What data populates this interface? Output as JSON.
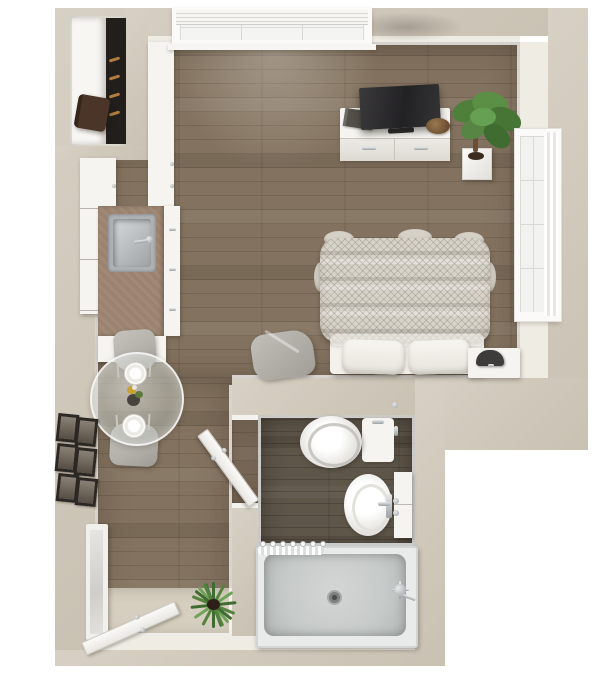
{
  "scene": {
    "title": "Studio apartment 3D top-down floor plan render",
    "view": "top-down 3D render",
    "rooms": [
      {
        "name": "living-sleeping-area"
      },
      {
        "name": "kitchenette"
      },
      {
        "name": "dining-nook"
      },
      {
        "name": "bathroom"
      },
      {
        "name": "entry"
      },
      {
        "name": "closet"
      }
    ],
    "objects": [
      "top-window-with-blinds",
      "side-window-with-curtain",
      "tv-console",
      "flat-screen-tv",
      "book",
      "decor-bowl",
      "potted-corner-plant",
      "bed-with-knit-blanket",
      "two-pillows",
      "nightstand",
      "lamp",
      "gray-lounge-pouf",
      "round-glass-dining-table",
      "two-dining-chairs",
      "two-place-settings",
      "flower-centerpiece",
      "kitchen-counter-with-sink",
      "upper-cabinets",
      "pantry-cabinet",
      "closet-shelf",
      "hanging-clothes",
      "duffel-bag",
      "gallery-wall-six-frames",
      "leaning-floor-mirror",
      "open-entry-door",
      "entry-mat",
      "spiky-floor-plant",
      "open-bathroom-door",
      "toilet",
      "pedestal-sink",
      "slim-storage-cabinet",
      "walk-in-shower",
      "shower-curtain-rod",
      "shower-drain",
      "shower-valve"
    ]
  },
  "colors": {
    "background": "#ffffff",
    "wall": "#d7d0c4",
    "wall_shade": "#c9c1b2",
    "wall_light": "#efece4",
    "floor_wood": "#83725f",
    "floor_wood_dark": "#5f564a",
    "entry_mat": "#d6cfc0",
    "counter": "#9b8370",
    "cabinet_white": "#f5f4f0",
    "stainless": "#aeb2b4",
    "tv_black": "#222124",
    "plant_green": "#55823f",
    "plant_dark": "#3c6030",
    "bed_blanket": "#d8d3c9",
    "pillow_white": "#f7f5f0",
    "chair_gray": "#b3b0aa",
    "frame_dark": "#2c2824",
    "shower_pan": "#c6cac9",
    "chrome_light": "#e8eaeb",
    "chrome_dark": "#9aa0a3",
    "glass_tint": "rgba(174,180,172,0.5)",
    "bag_brown": "#4a3528",
    "bowl_brown": "#6b4e30",
    "clothes_dark": "#211e1c",
    "hanger_tan": "#b07c3f"
  }
}
